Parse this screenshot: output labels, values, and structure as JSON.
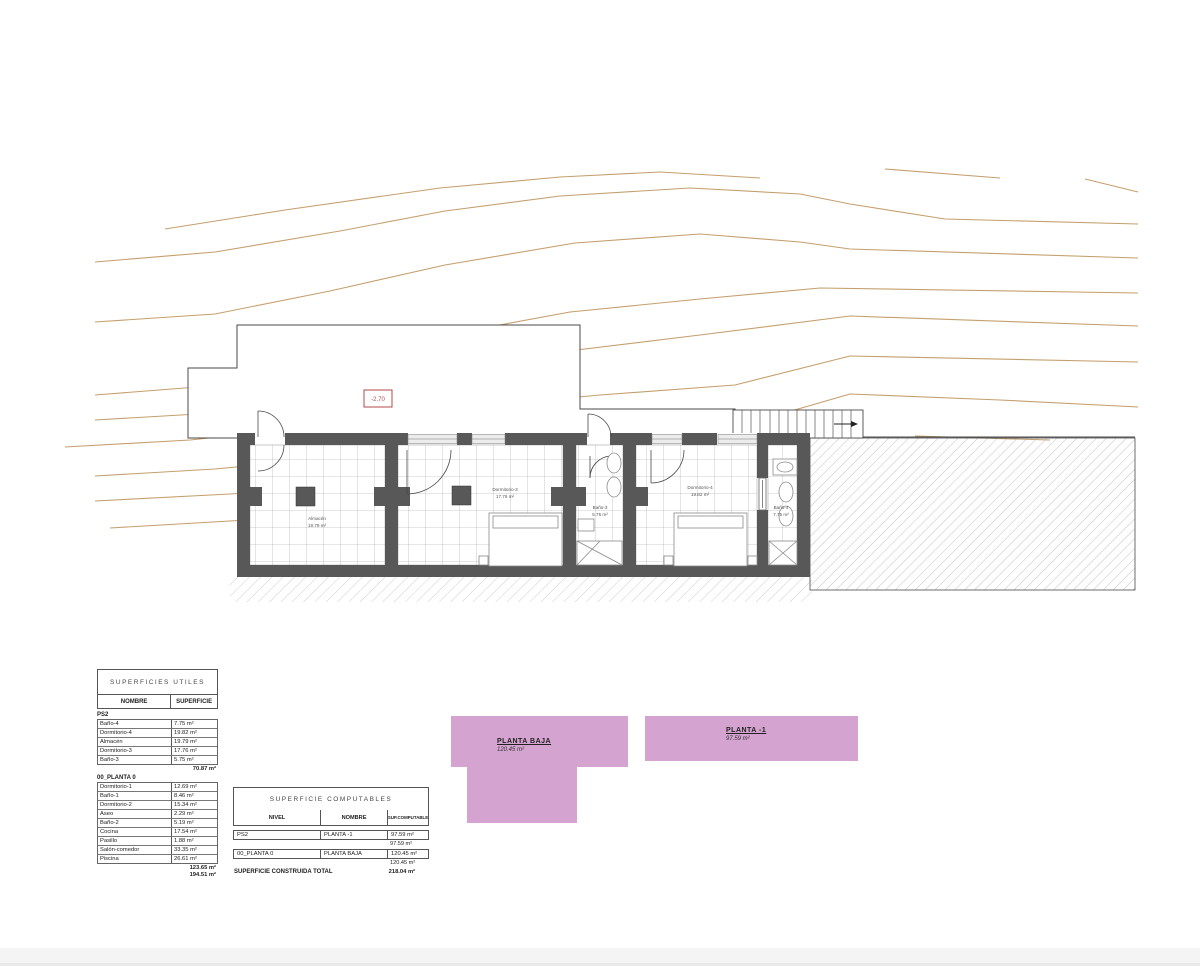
{
  "colors": {
    "contour": "#c59f6d",
    "wall": "#585858",
    "tile_line": "#9b9b9b",
    "hatch_line": "#a8a8a8",
    "outline": "#4a4a4a",
    "pink": "#d5a3d0",
    "marker_red": "#b24a4a",
    "footer_bar": "#f4f4f4"
  },
  "level_marker": {
    "value": "-2.70"
  },
  "plan_rooms": [
    {
      "name": "Almacén",
      "area": "19.79 m²"
    },
    {
      "name": "Dormitorio-3",
      "area": "17.76 m²"
    },
    {
      "name": "Baño-3",
      "area": "5.75 m²"
    },
    {
      "name": "Dormitorio-4",
      "area": "19.82 m²"
    },
    {
      "name": "Baño-4",
      "area": "7.75 m²"
    }
  ],
  "tables": {
    "utiles": {
      "title": "SUPERFICIES UTILES",
      "col_headers": [
        "NOMBRE",
        "SUPERFICIE"
      ],
      "sections": [
        {
          "name": "PS2",
          "rows": [
            [
              "Baño-4",
              "7.75 m²"
            ],
            [
              "Dormitorio-4",
              "19.82 m²"
            ],
            [
              "Almacén",
              "19.79 m²"
            ],
            [
              "Dormitorio-3",
              "17.76 m²"
            ],
            [
              "Baño-3",
              "5.75 m²"
            ]
          ],
          "totals": [
            "70.87 m²"
          ]
        },
        {
          "name": "00_PLANTA 0",
          "rows": [
            [
              "Dormitorio-1",
              "12.69 m²"
            ],
            [
              "Baño-1",
              "8.46 m²"
            ],
            [
              "Dormitorio-2",
              "15.34 m²"
            ],
            [
              "Aseo",
              "2.29 m²"
            ],
            [
              "Baño-2",
              "5.19 m²"
            ],
            [
              "Cocina",
              "17.54 m²"
            ],
            [
              "Pasillo",
              "1.88 m²"
            ],
            [
              "Salón-comedor",
              "33.35 m²"
            ],
            [
              "Piscina",
              "26.61 m²"
            ]
          ],
          "totals": [
            "123.65 m²",
            "194.51 m²"
          ]
        }
      ]
    },
    "computables": {
      "title": "SUPERFICIE COMPUTABLES",
      "col_headers": [
        "NIVEL",
        "NOMBRE",
        "SUP.COMPUTABLE"
      ],
      "rows": [
        {
          "nivel": "PS2",
          "nombre": "PLANTA -1",
          "sup": "97.59 m²",
          "subtotal": "97.59 m²"
        },
        {
          "nivel": "00_PLANTA 0",
          "nombre": "PLANTA BAJA",
          "sup": "120.45 m²",
          "subtotal": "120.45 m²"
        }
      ],
      "footer_label": "SUPERFICIE CONSTRUIDA TOTAL",
      "footer_value": "218.04 m²"
    }
  },
  "diagrams": [
    {
      "label": "PLANTA BAJA",
      "area": "120.45 m²"
    },
    {
      "label": "PLANTA -1",
      "area": "97.59 m²"
    }
  ]
}
